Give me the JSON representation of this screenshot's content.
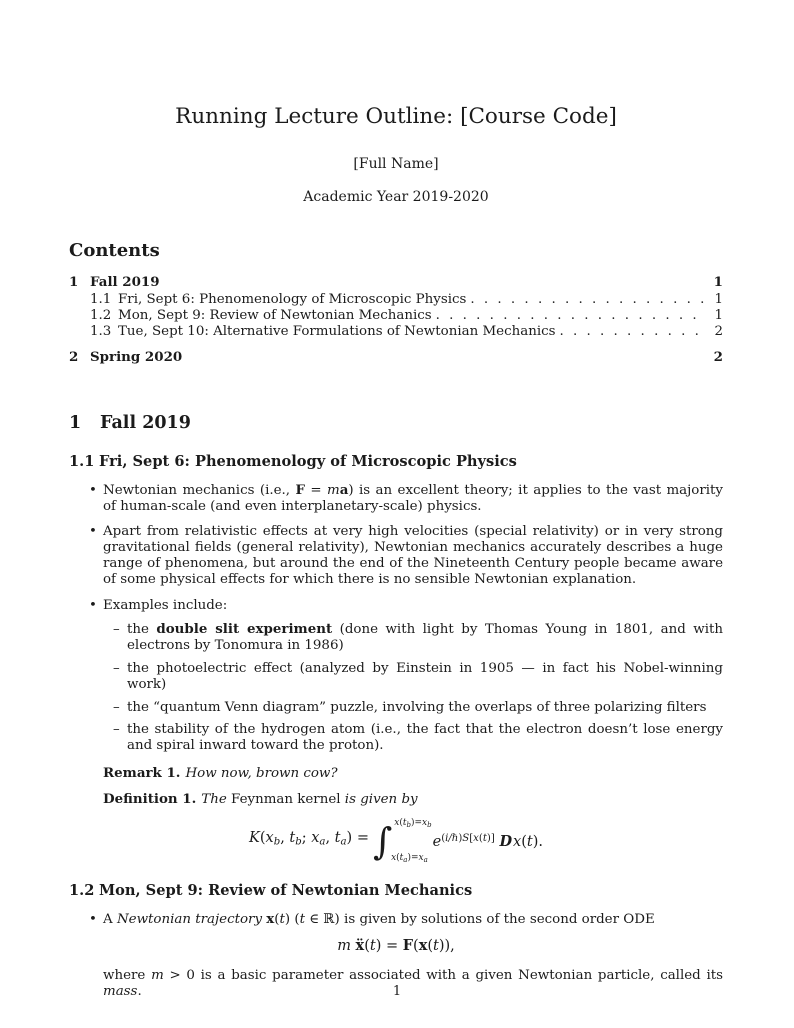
{
  "colors": {
    "background": "#ffffff",
    "text": "#1b1b1b"
  },
  "header": {
    "title": "Running Lecture Outline: [Course Code]",
    "author": "[Full Name]",
    "date": "Academic Year 2019-2020"
  },
  "toc": {
    "heading": "Contents",
    "entries": [
      {
        "num": "1",
        "label": "Fall 2019",
        "page": "1"
      },
      {
        "num": "1.1",
        "label": "Fri, Sept 6: Phenomenology of Microscopic Physics",
        "page": "1"
      },
      {
        "num": "1.2",
        "label": "Mon, Sept 9: Review of Newtonian Mechanics",
        "page": "1"
      },
      {
        "num": "1.3",
        "label": "Tue, Sept 10: Alternative Formulations of Newtonian Mechanics",
        "page": "2"
      },
      {
        "num": "2",
        "label": "Spring 2020",
        "page": "2"
      }
    ]
  },
  "section1": {
    "num": "1",
    "title": "Fall 2019"
  },
  "s11": {
    "num": "1.1",
    "title": "Fri, Sept 6: Phenomenology of Microscopic Physics",
    "b1": [
      [
        "n",
        "Newtonian mechanics (i.e., "
      ],
      [
        "b",
        "F"
      ],
      [
        "n",
        " = "
      ],
      [
        "i",
        "m"
      ],
      [
        "b",
        "a"
      ],
      [
        "n",
        ") is an excellent theory; it applies to the vast majority of human-scale (and even interplanetary-scale) physics."
      ]
    ],
    "b2": [
      [
        "n",
        "Apart from relativistic effects at very high velocities (special relativity) or in very strong gravitational fields (general relativity), Newtonian mechanics accurately describes a huge range of phenomena, but around the end of the Nineteenth Century people became aware of some physical effects for which there is no sensible Newtonian explanation."
      ]
    ],
    "b3_intro": [
      [
        "n",
        "Examples include:"
      ]
    ],
    "sub": [
      [
        [
          "n",
          "the "
        ],
        [
          "b",
          "double slit experiment"
        ],
        [
          "n",
          " (done with light by Thomas Young in 1801, and with electrons by Tonomura in 1986)"
        ]
      ],
      [
        [
          "n",
          "the photoelectric effect (analyzed by Einstein in 1905 — in fact his Nobel-winning work)"
        ]
      ],
      [
        [
          "n",
          "the “quantum Venn diagram” puzzle, involving the overlaps of three polarizing filters"
        ]
      ],
      [
        [
          "n",
          "the stability of the hydrogen atom (i.e., the fact that the electron doesn’t lose energy and spiral inward toward the proton)."
        ]
      ]
    ],
    "remark": {
      "label": "Remark 1.",
      "text": [
        [
          "i",
          "How now, brown cow?"
        ]
      ]
    },
    "definition": {
      "label": "Definition 1.",
      "lead": [
        [
          "i",
          "The "
        ],
        [
          "n",
          "Feynman kernel"
        ],
        [
          "i",
          " is given by"
        ]
      ],
      "eq_lhs": [
        [
          "i",
          "K"
        ],
        [
          "n",
          "("
        ],
        [
          "i",
          "x"
        ],
        [
          "sub",
          "b"
        ],
        [
          "n",
          ", "
        ],
        [
          "i",
          "t"
        ],
        [
          "sub",
          "b"
        ],
        [
          "n",
          "; "
        ],
        [
          "i",
          "x"
        ],
        [
          "sub",
          "a"
        ],
        [
          "n",
          ", "
        ],
        [
          "i",
          "t"
        ],
        [
          "sub",
          "a"
        ],
        [
          "n",
          ") ="
        ]
      ],
      "eq_upper": [
        [
          "i",
          "x"
        ],
        [
          "n",
          "("
        ],
        [
          "i",
          "t"
        ],
        [
          "sub",
          "b"
        ],
        [
          "n",
          ")="
        ],
        [
          "i",
          "x"
        ],
        [
          "sub",
          "b"
        ]
      ],
      "eq_lower": [
        [
          "i",
          "x"
        ],
        [
          "n",
          "("
        ],
        [
          "i",
          "t"
        ],
        [
          "sub",
          "a"
        ],
        [
          "n",
          ")="
        ],
        [
          "i",
          "x"
        ],
        [
          "sub",
          "a"
        ]
      ],
      "eq_body": [
        [
          "i",
          "e"
        ],
        [
          "supn",
          "("
        ],
        [
          "supi",
          "i/ℏ"
        ],
        [
          "supn",
          ")"
        ],
        [
          "supi",
          "S"
        ],
        [
          "supn",
          "["
        ],
        [
          "supi",
          "x"
        ],
        [
          "supn",
          "("
        ],
        [
          "supi",
          "t"
        ],
        [
          "supn",
          ")]"
        ],
        [
          "n",
          "  "
        ],
        [
          "scr",
          "D"
        ],
        [
          "i",
          "x"
        ],
        [
          "n",
          "("
        ],
        [
          "i",
          "t"
        ],
        [
          "n",
          ")."
        ]
      ]
    }
  },
  "s12": {
    "num": "1.2",
    "title": "Mon, Sept 9: Review of Newtonian Mechanics",
    "b1": [
      [
        "n",
        "A "
      ],
      [
        "i",
        "Newtonian trajectory"
      ],
      [
        "n",
        " "
      ],
      [
        "b",
        "x"
      ],
      [
        "n",
        "("
      ],
      [
        "i",
        "t"
      ],
      [
        "n",
        ") ("
      ],
      [
        "i",
        "t"
      ],
      [
        "n",
        " ∈ ℝ) is given by solutions of the second order ODE"
      ]
    ],
    "eq": [
      [
        "i",
        "m"
      ],
      [
        "n",
        " "
      ],
      [
        "b",
        "ẍ"
      ],
      [
        "n",
        "("
      ],
      [
        "i",
        "t"
      ],
      [
        "n",
        ") = "
      ],
      [
        "b",
        "F"
      ],
      [
        "n",
        "("
      ],
      [
        "b",
        "x"
      ],
      [
        "n",
        "("
      ],
      [
        "i",
        "t"
      ],
      [
        "n",
        ")),"
      ]
    ],
    "after": [
      [
        "n",
        "where "
      ],
      [
        "i",
        "m"
      ],
      [
        "n",
        " > 0 is a basic parameter associated with a given Newtonian particle, called its "
      ],
      [
        "i",
        "mass"
      ],
      [
        "n",
        "."
      ]
    ]
  },
  "footer": {
    "page_number": "1"
  }
}
